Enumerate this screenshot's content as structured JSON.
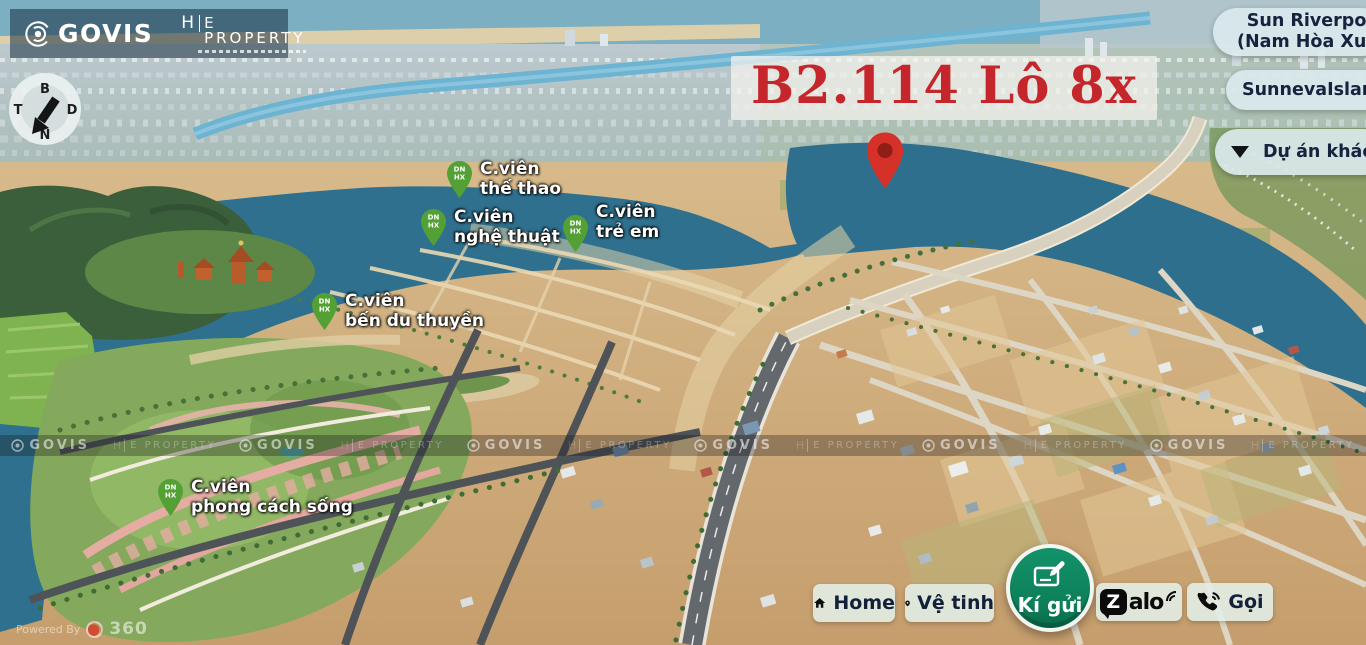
{
  "brand": {
    "govis": "GOVIS",
    "property_initial": "H",
    "property_rest": "E PROPERTY"
  },
  "compass": {
    "north": "B",
    "east": "D",
    "south": "N",
    "west": "T"
  },
  "lot_title": "B2.114 Lô 8x",
  "project_buttons": {
    "current": {
      "line1": "Sun Riverpolis",
      "line2": "(Nam Hòa Xuân)"
    },
    "sunneva": {
      "label": "SunnevaIsland"
    },
    "other": {
      "label": "Dự án khác"
    }
  },
  "park_pin": {
    "line1": "DN",
    "line2": "HX"
  },
  "park_labels": [
    {
      "line1": "C.viên",
      "line2": "thế thao"
    },
    {
      "line1": "C.viên",
      "line2": "nghệ thuật"
    },
    {
      "line1": "C.viên",
      "line2": "trẻ em"
    },
    {
      "line1": "C.viên",
      "line2": "bến du thuyền"
    },
    {
      "line1": "C.viên",
      "line2": "phong cách sống"
    }
  ],
  "controls": {
    "home": "Home",
    "satellite": "Vệ tinh",
    "consign": "Kí gửi",
    "zalo_z": "Z",
    "zalo_rest": "alo",
    "call": "Gọi"
  },
  "powered": {
    "prefix": "Powered By",
    "brand": "360"
  },
  "colors": {
    "title_red": "#c5262b",
    "marker_red": "#d63129",
    "pin_green": "#53a035",
    "consign_green": "#0e8a5f",
    "button_text": "#16233f",
    "pill_bg": "#e3efe8"
  }
}
